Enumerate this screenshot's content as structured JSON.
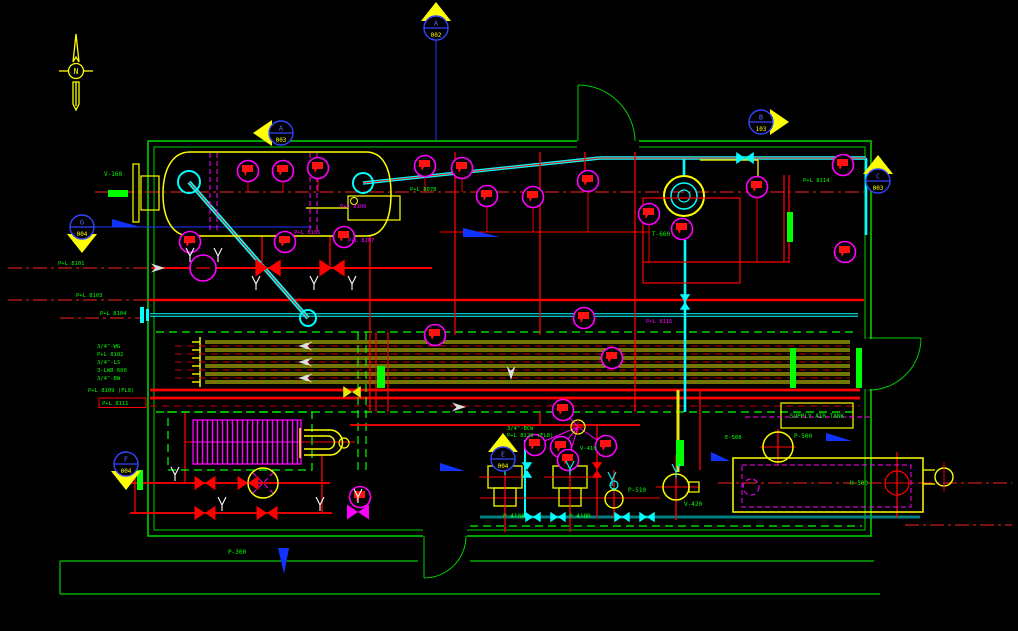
{
  "colors": {
    "background": "#000000",
    "walls": "#00cc00",
    "piping_red": "#ff0000",
    "piping_yellow": "#e8e800",
    "piping_cyan": "#00ffff",
    "instruments": "#ff00ff",
    "annotations": "#00ff00",
    "marker_fill": "#ffff00",
    "marker_letter": "#5566ff",
    "flow_tags": "#2233ff",
    "flow_arrows": "#dddddd"
  },
  "compass": {
    "letter": "N"
  },
  "section_markers": [
    {
      "x": 436,
      "y": 28,
      "dir": "up",
      "letter": "A",
      "number": "002"
    },
    {
      "x": 281,
      "y": 133,
      "dir": "left",
      "letter": "A",
      "number": "003"
    },
    {
      "x": 761,
      "y": 122,
      "dir": "right",
      "letter": "B",
      "number": "103"
    },
    {
      "x": 878,
      "y": 181,
      "dir": "up",
      "letter": "C",
      "number": "003"
    },
    {
      "x": 82,
      "y": 227,
      "dir": "down",
      "letter": "G",
      "number": "004"
    },
    {
      "x": 126,
      "y": 464,
      "dir": "down",
      "letter": "F",
      "number": "004"
    },
    {
      "x": 503,
      "y": 459,
      "dir": "up",
      "letter": "E",
      "number": "004"
    }
  ],
  "labels": [
    {
      "t": "V-160",
      "x": 104,
      "y": 176
    },
    {
      "t": "T-660",
      "x": 652,
      "y": 236
    },
    {
      "t": "H-500",
      "x": 850,
      "y": 485
    },
    {
      "t": "P-500",
      "x": 794,
      "y": 438
    },
    {
      "t": "P-510",
      "x": 628,
      "y": 492
    },
    {
      "t": "V-420",
      "x": 684,
      "y": 506
    },
    {
      "t": "V-410",
      "x": 580,
      "y": 450,
      "s": 5.5
    },
    {
      "t": "P-410A",
      "x": 503,
      "y": 518
    },
    {
      "t": "P-410B",
      "x": 569,
      "y": 518
    },
    {
      "t": "P-300",
      "x": 228,
      "y": 554
    },
    {
      "t": "E-508",
      "x": 725,
      "y": 439,
      "s": 5.5
    },
    {
      "t": "SUPPLY AIR TANK",
      "x": 817,
      "y": 418,
      "a": "middle",
      "s": 6
    },
    {
      "t": "3/4\"-WG",
      "x": 97,
      "y": 348,
      "s": 5.5
    },
    {
      "t": "P+L 8102",
      "x": 97,
      "y": 356,
      "s": 5.5
    },
    {
      "t": "3/4\"-LS",
      "x": 97,
      "y": 364,
      "s": 5.5
    },
    {
      "t": "3-LWR 600",
      "x": 97,
      "y": 372,
      "s": 5.5
    },
    {
      "t": "3/4\"-BW",
      "x": 97,
      "y": 380,
      "s": 5.5
    },
    {
      "t": "P+L 8109 (FL8)",
      "x": 88,
      "y": 392,
      "s": 5.5
    },
    {
      "t": "P+L 8111",
      "x": 102,
      "y": 405,
      "s": 5.5
    },
    {
      "t": "P+L 8101",
      "x": 58,
      "y": 265,
      "s": 5.5
    },
    {
      "t": "P+L 8103",
      "x": 76,
      "y": 297,
      "s": 5.5
    },
    {
      "t": "P+L 8104",
      "x": 100,
      "y": 315,
      "s": 5.5
    },
    {
      "t": "P+L 8105",
      "x": 294,
      "y": 234,
      "c": "#ff00ff",
      "s": 5.5
    },
    {
      "t": "P+L 8106",
      "x": 340,
      "y": 208,
      "c": "#ff00ff",
      "s": 5.5
    },
    {
      "t": "P+L 8107",
      "x": 348,
      "y": 242,
      "c": "#ff00ff",
      "s": 5.5
    },
    {
      "t": "P+L 8078",
      "x": 410,
      "y": 191,
      "s": 5.5
    },
    {
      "t": "P+L 8114",
      "x": 803,
      "y": 182,
      "s": 5.5
    },
    {
      "t": "P+L 8116",
      "x": 646,
      "y": 323,
      "c": "#ff00ff",
      "s": 5.5
    },
    {
      "t": "3/4\"-BCW",
      "x": 507,
      "y": 430,
      "s": 5.5
    },
    {
      "t": "P+L 8120 (FL8)",
      "x": 507,
      "y": 437,
      "s": 5.5
    }
  ],
  "instrument_bubbles": [
    [
      248,
      171
    ],
    [
      283,
      171
    ],
    [
      318,
      168
    ],
    [
      425,
      166
    ],
    [
      462,
      168
    ],
    [
      487,
      196
    ],
    [
      533,
      197
    ],
    [
      588,
      181
    ],
    [
      649,
      214
    ],
    [
      682,
      229
    ],
    [
      757,
      187
    ],
    [
      843,
      165
    ],
    [
      845,
      252
    ],
    [
      190,
      242
    ],
    [
      285,
      242
    ],
    [
      344,
      237
    ],
    [
      435,
      335
    ],
    [
      584,
      318
    ],
    [
      612,
      358
    ],
    [
      563,
      410
    ],
    [
      535,
      445
    ],
    [
      561,
      447
    ],
    [
      568,
      460
    ],
    [
      606,
      446
    ],
    [
      360,
      497
    ]
  ],
  "valves": [
    {
      "x": 268,
      "y": 268,
      "c": "#ff0000",
      "r": 0,
      "s": 1.15
    },
    {
      "x": 332,
      "y": 268,
      "c": "#ff0000",
      "r": 0,
      "s": 1.15
    },
    {
      "x": 205,
      "y": 483,
      "c": "#ff0000",
      "r": 0,
      "s": 0.95
    },
    {
      "x": 248,
      "y": 483,
      "c": "#ff0000",
      "r": 0,
      "s": 0.95
    },
    {
      "x": 205,
      "y": 513,
      "c": "#ff0000",
      "r": 0,
      "s": 0.95
    },
    {
      "x": 267,
      "y": 513,
      "c": "#ff0000",
      "r": 0,
      "s": 0.95
    },
    {
      "x": 352,
      "y": 392,
      "c": "#e8e800",
      "r": 0,
      "s": 0.8
    },
    {
      "x": 358,
      "y": 512,
      "c": "#ff00ff",
      "r": 0,
      "s": 1
    },
    {
      "x": 533,
      "y": 517,
      "c": "#00ffff",
      "r": 0,
      "s": 0.7
    },
    {
      "x": 558,
      "y": 517,
      "c": "#00ffff",
      "r": 0,
      "s": 0.7
    },
    {
      "x": 622,
      "y": 517,
      "c": "#00ffff",
      "r": 0,
      "s": 0.7
    },
    {
      "x": 647,
      "y": 517,
      "c": "#00ffff",
      "r": 0,
      "s": 0.7
    },
    {
      "x": 527,
      "y": 470,
      "c": "#00ffff",
      "r": 90,
      "s": 0.7
    },
    {
      "x": 685,
      "y": 302,
      "c": "#00ffff",
      "r": 90,
      "s": 0.7
    },
    {
      "x": 745,
      "y": 158,
      "c": "#00ffff",
      "r": 0,
      "s": 0.8
    },
    {
      "x": 597,
      "y": 470,
      "c": "#ff0000",
      "r": 90,
      "s": 0.7
    }
  ],
  "vent_stems": [
    [
      190,
      253
    ],
    [
      218,
      253
    ],
    [
      256,
      281
    ],
    [
      314,
      281
    ],
    [
      352,
      281
    ],
    [
      130,
      472
    ],
    [
      175,
      472
    ],
    [
      222,
      502
    ],
    [
      320,
      502
    ],
    [
      505,
      466,
      "c"
    ],
    [
      570,
      466,
      "c"
    ],
    [
      676,
      469,
      "c"
    ],
    [
      612,
      477,
      "c"
    ],
    [
      358,
      494
    ]
  ],
  "flow_arrows": [
    [
      165,
      268,
      "r"
    ],
    [
      298,
      346,
      "l"
    ],
    [
      298,
      362,
      "l"
    ],
    [
      298,
      378,
      "l"
    ],
    [
      466,
      407,
      "r"
    ],
    [
      511,
      380,
      "d"
    ]
  ],
  "green_bars": [
    [
      108,
      190,
      20,
      7
    ],
    [
      377,
      366,
      8,
      22
    ],
    [
      676,
      440,
      8,
      26
    ],
    [
      787,
      212,
      6,
      30
    ],
    [
      790,
      348,
      6,
      40
    ],
    [
      856,
      348,
      6,
      40
    ],
    [
      137,
      470,
      6,
      20
    ]
  ]
}
